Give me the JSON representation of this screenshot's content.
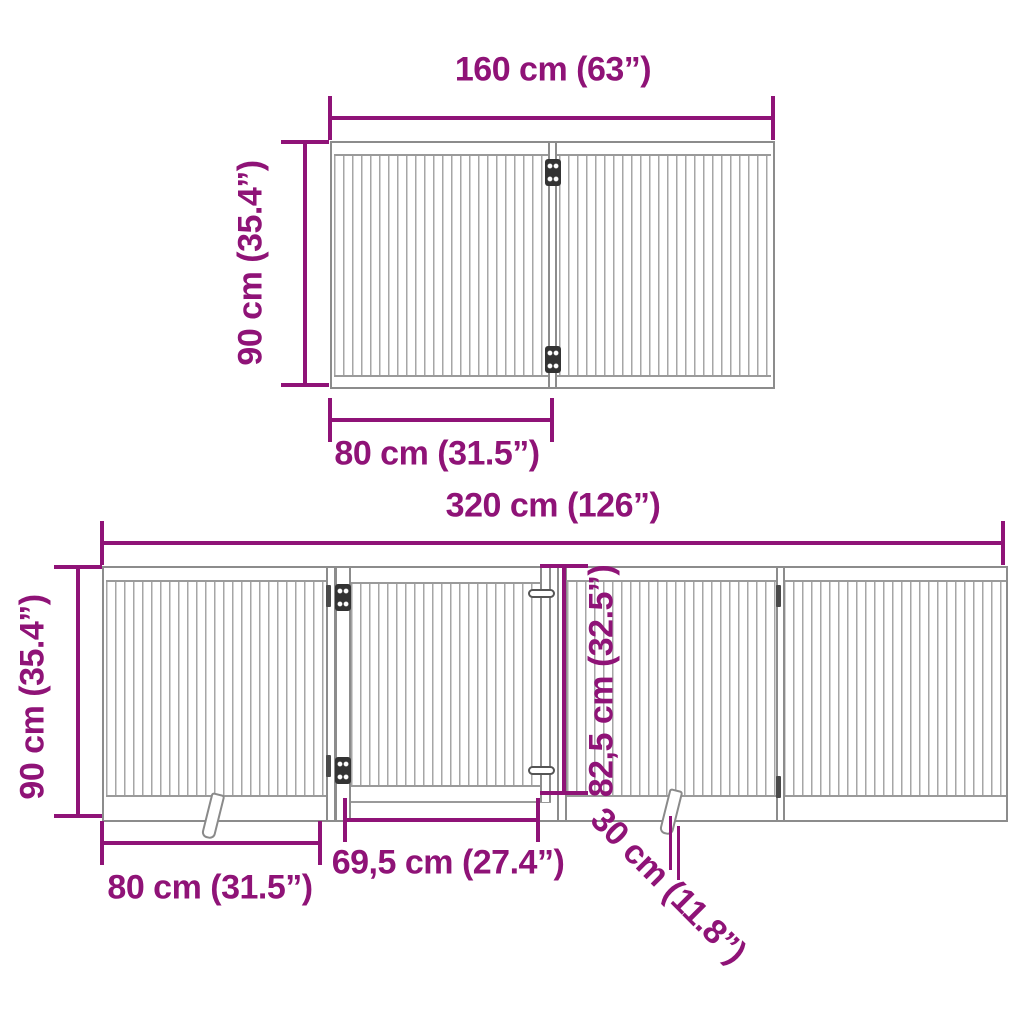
{
  "colors": {
    "dimension_accent": "#8F1377",
    "structure_outline": "#8c8c8c"
  },
  "top_diagram": {
    "description": "folded-2-panel-gate",
    "width_label": "160 cm (63”)",
    "height_label": "90 cm (35.4”)",
    "panel_width_label": "80 cm (31.5”)"
  },
  "bottom_diagram": {
    "description": "extended-4-panel-gate-with-door",
    "width_label": "320 cm (126”)",
    "height_label": "90 cm (35.4”)",
    "panel_width_label": "80 cm (31.5”)",
    "door_width_label": "69,5 cm (27.4”)",
    "door_height_label": "82,5 cm (32.5”)",
    "foot_depth_label": "30 cm (11.8”)"
  }
}
